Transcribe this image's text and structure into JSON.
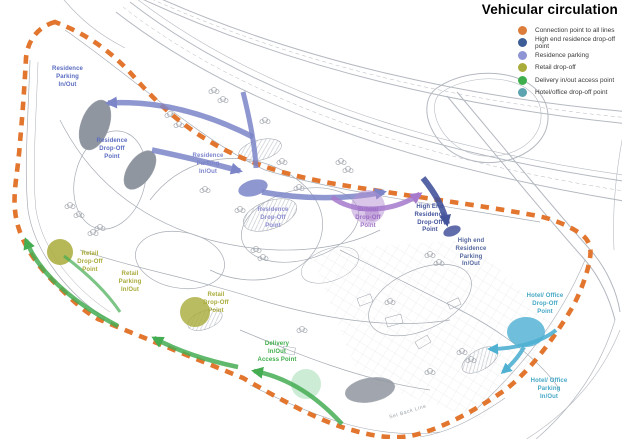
{
  "legend": {
    "title": "Vehicular circulation",
    "items": [
      {
        "label": "Connection point to all lines",
        "color": "#dd7d3c"
      },
      {
        "label": "High end residence drop-off point",
        "color": "#3c5d95"
      },
      {
        "label": "Residence parking",
        "color": "#8f94d4"
      },
      {
        "label": "Retail drop-off",
        "color": "#a9ab3a"
      },
      {
        "label": "Delivery in/out access point",
        "color": "#3fae4c"
      },
      {
        "label": "Hotel/office drop-off point",
        "color": "#5ea3b0"
      }
    ]
  },
  "map": {
    "labels": [
      {
        "text": "Residence\nParking\nIn/Out",
        "color": "#5a6cc0"
      },
      {
        "text": "Residence\nDrop-Off\nPoint",
        "color": "#5a6cc0"
      },
      {
        "text": "Residence\nParking\nIn/Out",
        "color": "#7d85cc"
      },
      {
        "text": "Residence\nDrop-Off\nPoint",
        "color": "#8d8dd0"
      },
      {
        "text": "School\nDrop-Off\nPoint",
        "color": "#9b6fc5"
      },
      {
        "text": "High End\nResidence\nDrop-Off\nPoint",
        "color": "#44549b"
      },
      {
        "text": "High end\nResidence\nParking\nIn/Out",
        "color": "#56699f"
      },
      {
        "text": "Hotel/ Office\nDrop-Off\nPoint",
        "color": "#45a8c5"
      },
      {
        "text": "Hotel/ Office\nParking\nIn/Out",
        "color": "#45a8c5"
      },
      {
        "text": "Retail\nDrop-Off\nPoint",
        "color": "#a9ab3a"
      },
      {
        "text": "Retail\nParking\nIn/Out",
        "color": "#a9ab3a"
      },
      {
        "text": "Retail\nDrop-Off\nPoint",
        "color": "#a9ab3a"
      },
      {
        "text": "Delivery\nIn/Out\nAccess Point",
        "color": "#3fae4c"
      },
      {
        "text": "Set Back Line",
        "color": "#9aa0a6"
      }
    ]
  }
}
